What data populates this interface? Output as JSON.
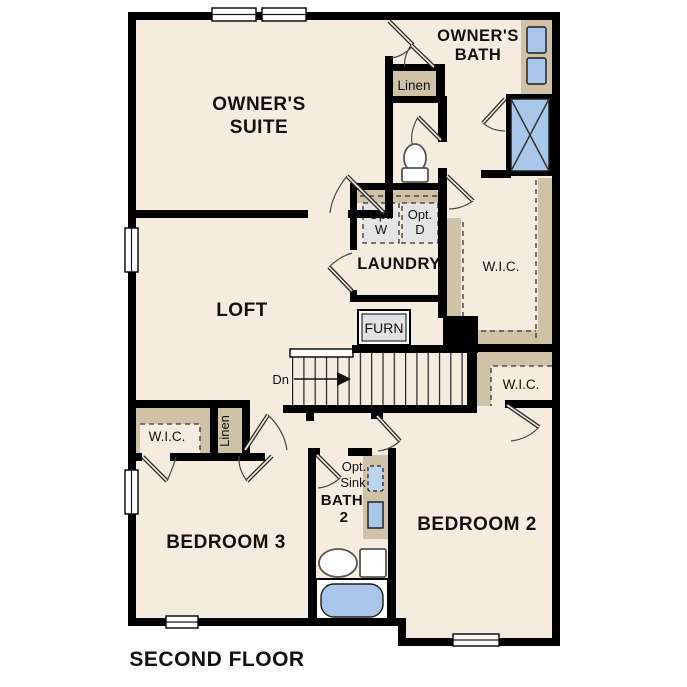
{
  "plan": {
    "floor_title": "SECOND FLOOR",
    "colors": {
      "floor": "#f5ecdf",
      "wall": "#000000",
      "casework": "#cfc2a7",
      "fixture_blue": "#a9c8e9",
      "appliance_gray": "#e4e4e4"
    },
    "rooms": {
      "owners_suite": {
        "line1": "OWNER'S",
        "line2": "SUITE"
      },
      "owners_bath": {
        "line1": "OWNER'S",
        "line2": "BATH"
      },
      "loft": {
        "label": "LOFT"
      },
      "laundry": {
        "label": "LAUNDRY"
      },
      "bath2": {
        "line1": "BATH",
        "line2": "2"
      },
      "bedroom2": {
        "label": "BEDROOM 2"
      },
      "bedroom3": {
        "label": "BEDROOM 3"
      },
      "owners_wic": {
        "label": "W.I.C."
      },
      "bedroom2_wic": {
        "label": "W.I.C."
      },
      "bedroom3_wic": {
        "label": "W.I.C."
      },
      "hall_linen": {
        "label": "Linen"
      },
      "bedroom3_linen": {
        "label": "Linen"
      }
    },
    "fixtures": {
      "washer": {
        "line1": "Opt.",
        "line2": "W"
      },
      "dryer": {
        "line1": "Opt.",
        "line2": "D"
      },
      "furnace": {
        "label": "FURN"
      },
      "stairs": {
        "direction": "Dn"
      },
      "opt_sink": {
        "line1": "Opt.",
        "line2": "Sink"
      }
    }
  }
}
